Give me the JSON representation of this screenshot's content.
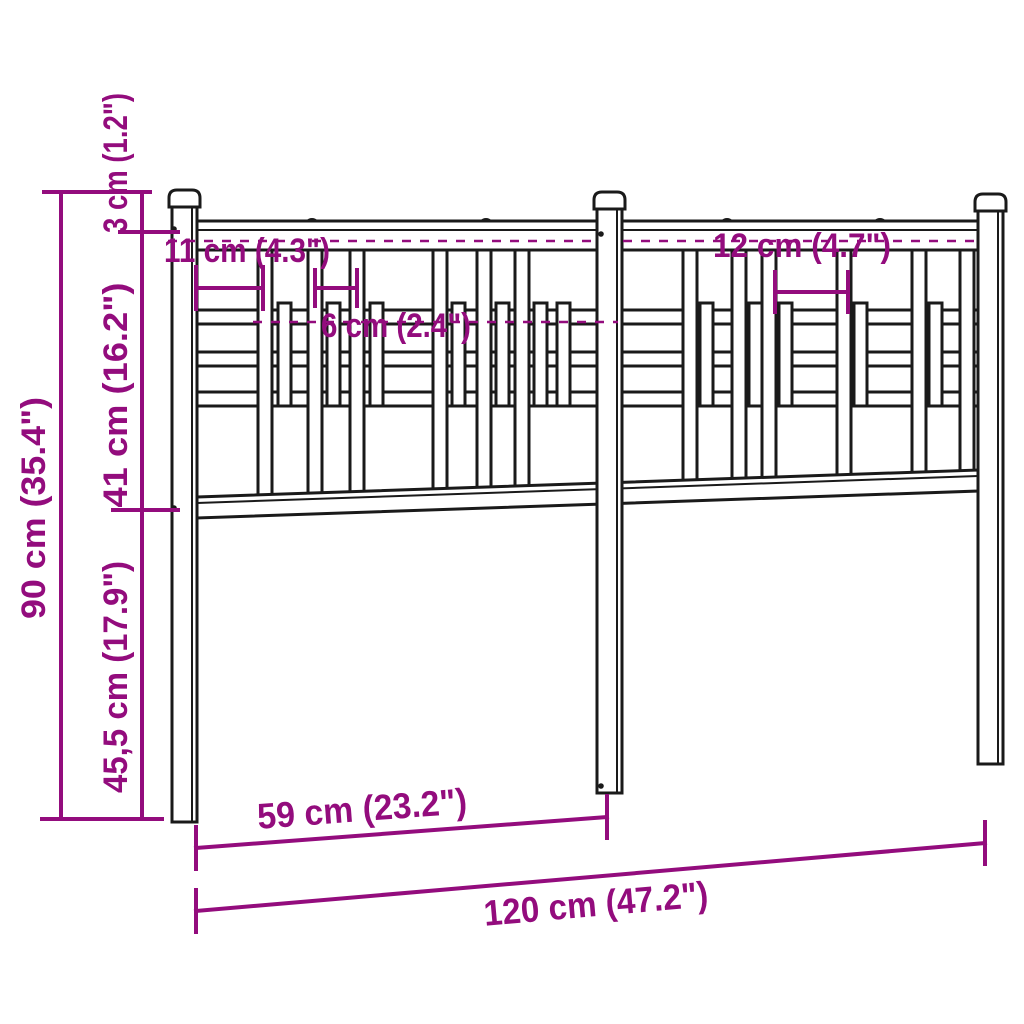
{
  "page": {
    "title": "Metal headboard dimension diagram",
    "background": "#ffffff"
  },
  "colors": {
    "dimension": "#930c7d",
    "outline": "#1a1a1a"
  },
  "dimensions": {
    "total_height": "90 cm (35.4\")",
    "post_cap_offset": "3 cm (1.2\")",
    "grid_panel_height": "41 cm (16.2\")",
    "lower_post_height": "45,5 cm (17.9\")",
    "post_to_first_bar": "11 cm (4.3\")",
    "narrow_bar_spacing": "6 cm (2.4\")",
    "wide_bar_spacing": "12 cm (4.7\")",
    "post_spacing": "59 cm (23.2\")",
    "total_width": "120 cm (47.2\")"
  }
}
